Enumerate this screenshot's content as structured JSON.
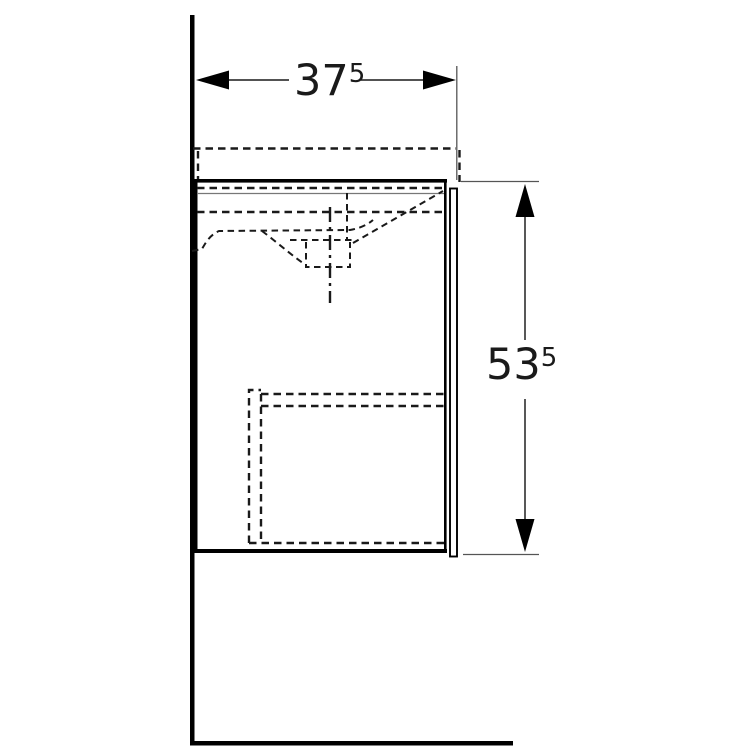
{
  "drawing": {
    "dimensions": {
      "width": {
        "main": "37",
        "sup": "5"
      },
      "height": {
        "main": "53",
        "sup": "5"
      }
    },
    "colors": {
      "solid_line": "#000000",
      "dashed_line": "#1a1a1a",
      "dimension_line": "#3a3a3a",
      "extension_line": "#555555",
      "background": "#ffffff"
    }
  }
}
